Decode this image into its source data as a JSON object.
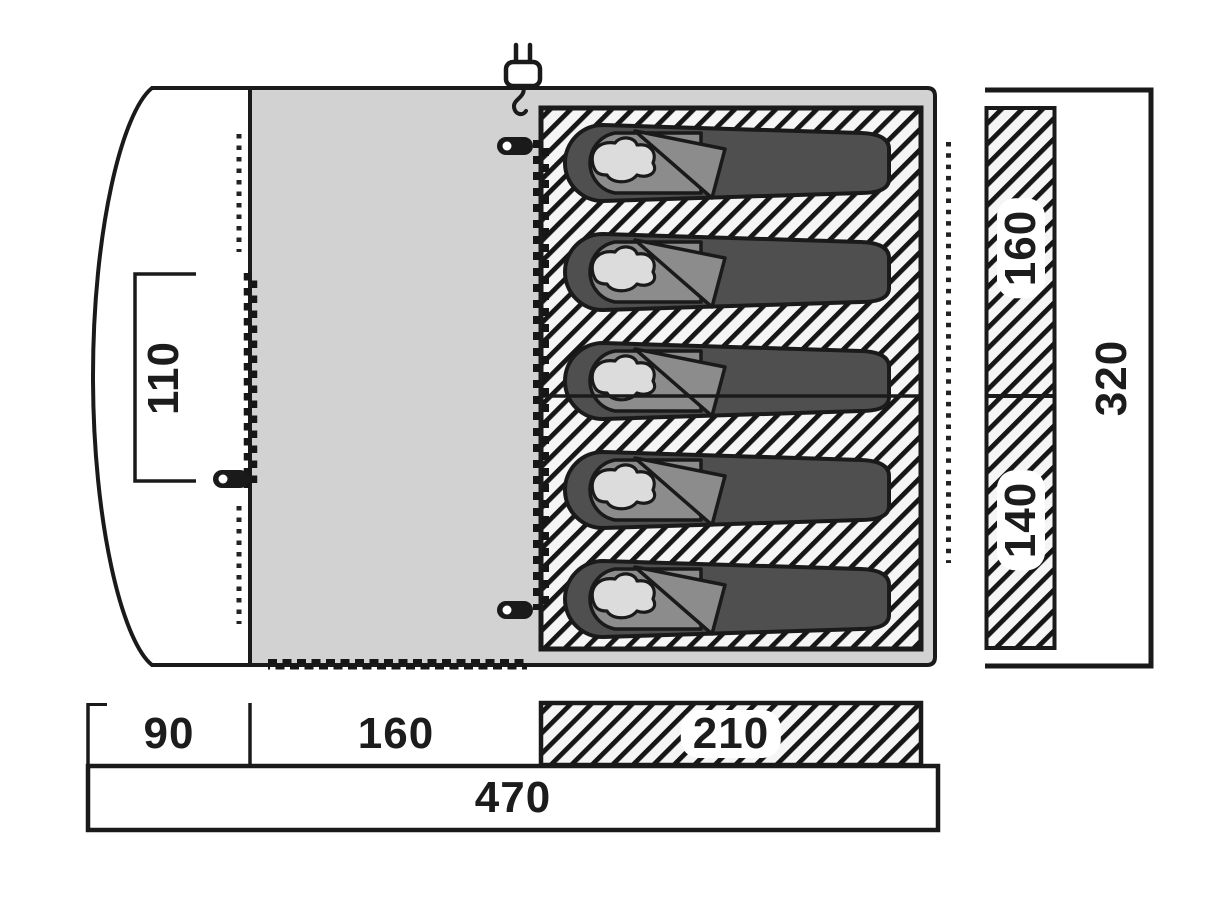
{
  "diagram": {
    "type": "tent-floorplan-top-view",
    "sleeping_bag_count": 5
  },
  "labels": {
    "porch_door_width": "110",
    "cabin_width_top": "160",
    "cabin_width_bottom": "140",
    "depth_total": "320",
    "section_porch_width": "90",
    "section_living_width": "160",
    "section_sleeping_width": "210",
    "width_total": "470"
  },
  "icons": {
    "power_plug": "power-plug-icon",
    "zipper_pull": "zipper-pull-icon",
    "zipper_teeth": "zipper-teeth-line",
    "seam_dots": "dotted-seam-line"
  },
  "colors": {
    "canvas": "#ffffff",
    "living_area": "#d2d2d2",
    "outline": "#1a1a1a",
    "hatch_background": "#f5f5f5",
    "sleeping_bag_body": "#4f4f4f",
    "sleeping_bag_head": "#8c8c8c",
    "pillow": "#dcdcdc"
  }
}
